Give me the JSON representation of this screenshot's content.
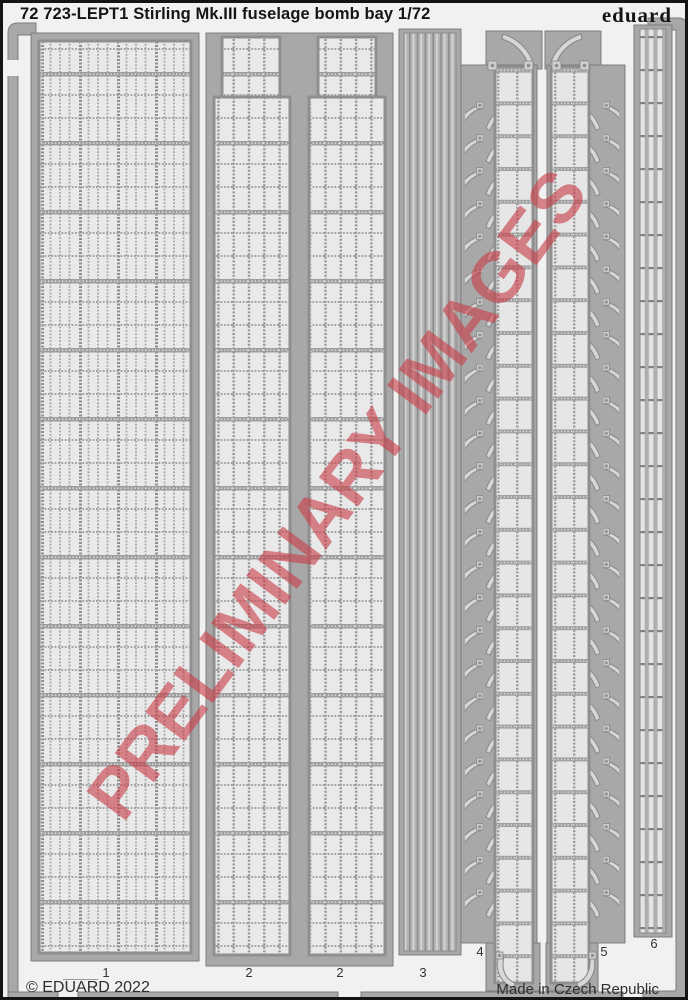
{
  "header": {
    "title": "72 723-LEPT1 Stirling Mk.III fuselage bomb bay 1/72",
    "brand": "eduard"
  },
  "footer": {
    "copyright": "© EDUARD 2022",
    "made_in": "Made in Czech Republic"
  },
  "watermark": {
    "text": "PRELIMINARY IMAGES"
  },
  "sheet": {
    "parts": [
      {
        "label": "1"
      },
      {
        "label": "2"
      },
      {
        "label": "2"
      },
      {
        "label": "3"
      },
      {
        "label": "4"
      },
      {
        "label": "5"
      },
      {
        "label": "6"
      }
    ]
  },
  "colors": {
    "page_bg": "#f1f1f1",
    "fret_grey": "#a8a8a8",
    "part_light": "#e9e9e9",
    "watermark_red": "#c9404a",
    "border_black": "#141414"
  }
}
